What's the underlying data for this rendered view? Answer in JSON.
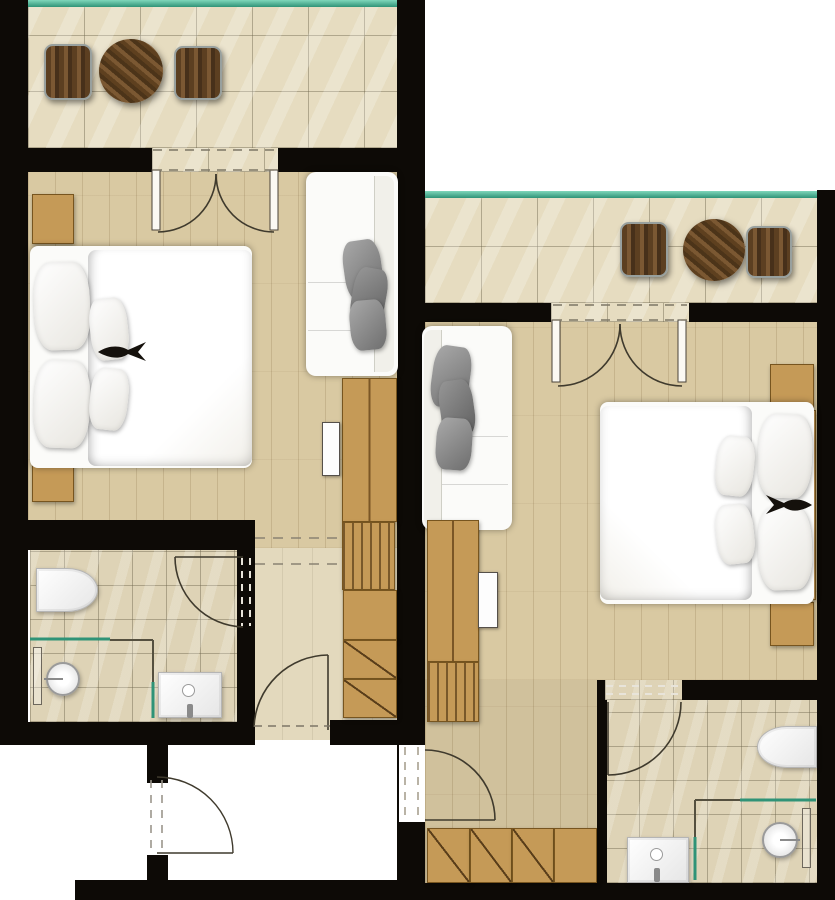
{
  "palette": {
    "wall": "#0d0a06",
    "tile": "#e6dcc0",
    "tileBath": "#ded3b6",
    "wood": "#d9c9a2",
    "corridor": "#e3d9bd",
    "furnWood": "#c59a57",
    "furnWoodDark": "#77551f",
    "teal": "#2f9377",
    "tealBright": "#57bd9d",
    "white": "#ffffff",
    "pillow": "#8d8d8d",
    "line": "#3b372c"
  },
  "plan": {
    "type": "floor-plan",
    "units": [
      {
        "name": "left-unit",
        "rooms": [
          {
            "name": "balcony",
            "floor": "stone tile",
            "railing": "glass (teal)",
            "furniture": [
              "lounge chair",
              "round bistro table",
              "lounge chair"
            ]
          },
          {
            "name": "bedroom",
            "floor": "wood plank",
            "furniture": [
              "double bed with duvet and pillows",
              "nightstand",
              "nightstand",
              "sofa with gray cushions",
              "wall tv",
              "wardrobe with luggage-rack slats",
              "closet shelves with hanging sections"
            ]
          },
          {
            "name": "bathroom",
            "floor": "stone tile",
            "furniture": [
              "wall-hung toilet",
              "walk-in shower with glass screen",
              "washbasin"
            ],
            "door": "swing door from corridor"
          },
          {
            "name": "entry-corridor",
            "floor": "pale screed",
            "features": [
              "ceiling break dashed lines",
              "entry swing door",
              "vestibule swing door"
            ]
          }
        ]
      },
      {
        "name": "right-unit",
        "rooms": [
          {
            "name": "balcony",
            "floor": "stone tile",
            "railing": "glass (teal)",
            "furniture": [
              "lounge chair",
              "round bistro table",
              "lounge chair"
            ]
          },
          {
            "name": "bedroom",
            "floor": "wood plank",
            "furniture": [
              "double bed with duvet and pillows",
              "nightstand",
              "nightstand",
              "sofa with gray cushions",
              "wall tv",
              "media console with slatted base",
              "built-in closet (diagonal-marked fronts)"
            ]
          },
          {
            "name": "bathroom",
            "floor": "stone tile",
            "furniture": [
              "wall-hung toilet",
              "walk-in shower with glass screen",
              "washbasin"
            ],
            "door": "swing door from bedroom"
          },
          {
            "name": "entry-corridor",
            "floor": "wood plank",
            "features": [
              "entry swing door in party wall",
              "built-in closet row"
            ]
          }
        ]
      }
    ],
    "symbols": {
      "door": "quarter-circle swing arc with leaf line",
      "double_door": "two mirrored arcs meeting at centre",
      "dashed_line": "opening / ceiling break",
      "teal_line": "glass (railing or shower screen)"
    }
  }
}
